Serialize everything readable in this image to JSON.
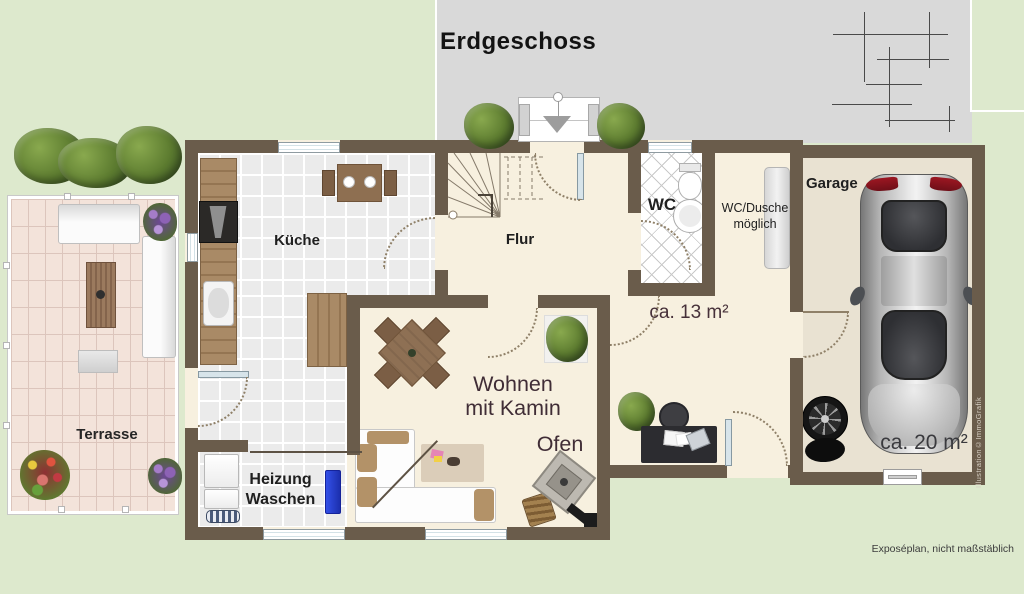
{
  "title": "Erdgeschoss",
  "rooms": {
    "kueche": {
      "label": "Küche"
    },
    "flur": {
      "label": "Flur"
    },
    "wc": {
      "label": "WC"
    },
    "wc_dusche": {
      "line1": "WC/Dusche",
      "line2": "möglich"
    },
    "office": {
      "area": "ca. 13 m²"
    },
    "wohnen": {
      "line1": "Wohnen",
      "line2": "mit Kamin",
      "ofen": "Ofen"
    },
    "heizung": {
      "line1": "Heizung",
      "line2": "Waschen"
    },
    "garage": {
      "label": "Garage",
      "area": "ca. 20 m²"
    },
    "terrasse": {
      "label": "Terrasse"
    }
  },
  "annotations": {
    "disclaimer": "Exposéplan, nicht maßstäblich",
    "watermark": "Illustration©ImmoGrafik"
  },
  "colors": {
    "grass": "#dde9cd",
    "driveway": "#d9d9d9",
    "wall": "#6a5c4b",
    "floor": "#f7f0df",
    "kitchen_tile": "#ebebeb",
    "terrace_brick": "#f3e3da",
    "garage_floor": "#e9e2d2",
    "label_dark": "#1f1f1f",
    "label_accent": "#402d36",
    "radiator_blue": "#2b3fd6"
  }
}
